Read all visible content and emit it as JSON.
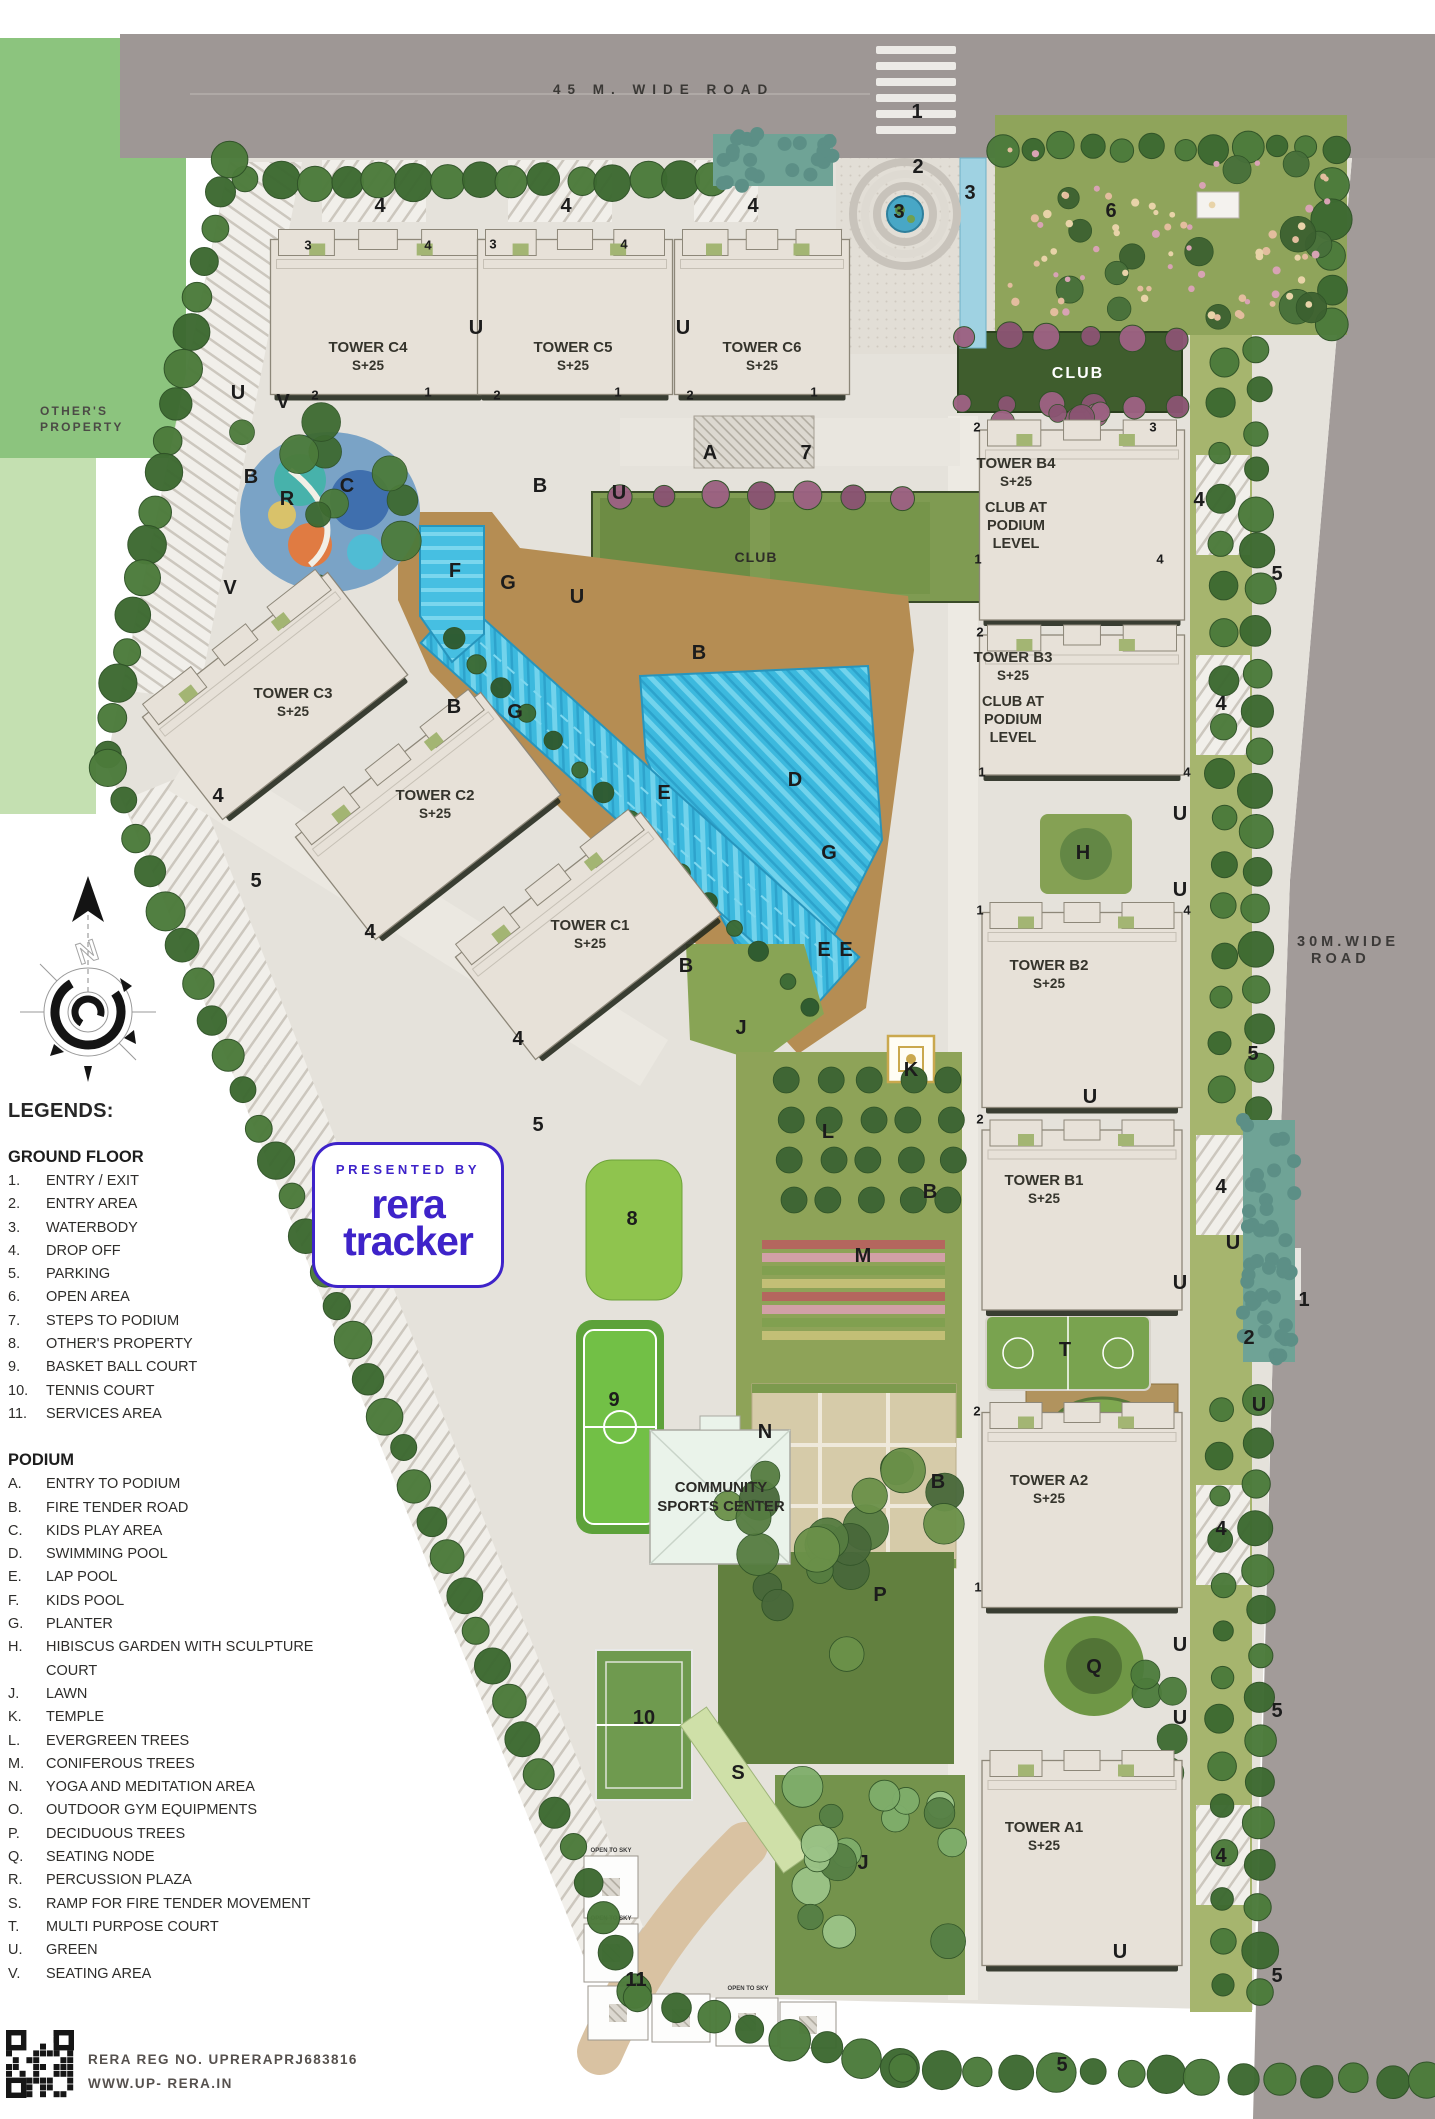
{
  "roads": {
    "top_label": "45 M. WIDE ROAD",
    "right_line1": "30M.WIDE",
    "right_line2": "ROAD"
  },
  "neighbor": {
    "line1": "OTHER'S",
    "line2": "PROPERTY"
  },
  "legend": {
    "title": "LEGENDS:",
    "sections": [
      {
        "title": "GROUND FLOOR",
        "items": [
          {
            "key": "1.",
            "label": "ENTRY / EXIT"
          },
          {
            "key": "2.",
            "label": "ENTRY AREA"
          },
          {
            "key": "3.",
            "label": "WATERBODY"
          },
          {
            "key": "4.",
            "label": "DROP OFF"
          },
          {
            "key": "5.",
            "label": "PARKING"
          },
          {
            "key": "6.",
            "label": "OPEN AREA"
          },
          {
            "key": "7.",
            "label": "STEPS TO PODIUM"
          },
          {
            "key": "8.",
            "label": "OTHER'S PROPERTY"
          },
          {
            "key": "9.",
            "label": "BASKET BALL COURT"
          },
          {
            "key": "10.",
            "label": "TENNIS COURT"
          },
          {
            "key": "11.",
            "label": "SERVICES AREA"
          }
        ]
      },
      {
        "title": "PODIUM",
        "items": [
          {
            "key": "A.",
            "label": "ENTRY TO PODIUM"
          },
          {
            "key": "B.",
            "label": "FIRE TENDER ROAD"
          },
          {
            "key": "C.",
            "label": "KIDS PLAY AREA"
          },
          {
            "key": "D.",
            "label": "SWIMMING POOL"
          },
          {
            "key": "E.",
            "label": "LAP POOL"
          },
          {
            "key": "F.",
            "label": "KIDS POOL"
          },
          {
            "key": "G.",
            "label": "PLANTER"
          },
          {
            "key": "H.",
            "label": "HIBISCUS GARDEN WITH SCULPTURE COURT"
          },
          {
            "key": "J.",
            "label": "LAWN"
          },
          {
            "key": "K.",
            "label": "TEMPLE"
          },
          {
            "key": "L.",
            "label": "EVERGREEN TREES"
          },
          {
            "key": "M.",
            "label": "CONIFEROUS TREES"
          },
          {
            "key": "N.",
            "label": "YOGA AND MEDITATION AREA"
          },
          {
            "key": "O.",
            "label": "OUTDOOR GYM EQUIPMENTS"
          },
          {
            "key": "P.",
            "label": "DECIDUOUS TREES"
          },
          {
            "key": "Q.",
            "label": "SEATING NODE"
          },
          {
            "key": "R.",
            "label": "PERCUSSION PLAZA"
          },
          {
            "key": "S.",
            "label": "RAMP FOR FIRE TENDER MOVEMENT"
          },
          {
            "key": "T.",
            "label": "MULTI PURPOSE COURT"
          },
          {
            "key": "U.",
            "label": "GREEN"
          },
          {
            "key": "V.",
            "label": "SEATING AREA"
          }
        ]
      }
    ]
  },
  "badge": {
    "presented_by": "PRESENTED BY",
    "brand_line1": "rera",
    "brand_line2": "tracker",
    "color": "#3e23c9"
  },
  "footer": {
    "reg": "RERA REG NO. UPRERAPRJ683816",
    "site": "WWW.UP- RERA.IN"
  },
  "map": {
    "towers": [
      {
        "id": "c4",
        "name": "TOWER C4",
        "floors": "S+25",
        "x": 378,
        "y": 312,
        "w": 215,
        "h": 165,
        "rot": 0,
        "lx": 368,
        "ly": 352
      },
      {
        "id": "c5",
        "name": "TOWER C5",
        "floors": "S+25",
        "x": 575,
        "y": 312,
        "w": 195,
        "h": 165,
        "rot": 0,
        "lx": 573,
        "ly": 352
      },
      {
        "id": "c6",
        "name": "TOWER C6",
        "floors": "S+25",
        "x": 762,
        "y": 312,
        "w": 175,
        "h": 165,
        "rot": 0,
        "lx": 762,
        "ly": 352
      },
      {
        "id": "b4",
        "name": "TOWER B4",
        "floors": "S+25",
        "x": 1082,
        "y": 520,
        "w": 205,
        "h": 200,
        "rot": 0,
        "lx": 1016,
        "ly": 468,
        "extra": [
          "CLUB AT",
          "PODIUM",
          "LEVEL"
        ]
      },
      {
        "id": "b3",
        "name": "TOWER B3",
        "floors": "S+25",
        "x": 1082,
        "y": 700,
        "w": 205,
        "h": 150,
        "rot": 0,
        "lx": 1013,
        "ly": 662,
        "extra": [
          "CLUB AT",
          "PODIUM",
          "LEVEL"
        ]
      },
      {
        "id": "c3",
        "name": "TOWER C3",
        "floors": "S+25",
        "x": 272,
        "y": 692,
        "w": 235,
        "h": 140,
        "rot": -38,
        "lx": 293,
        "ly": 698
      },
      {
        "id": "c2",
        "name": "TOWER C2",
        "floors": "S+25",
        "x": 425,
        "y": 812,
        "w": 235,
        "h": 140,
        "rot": -38,
        "lx": 435,
        "ly": 800
      },
      {
        "id": "c1",
        "name": "TOWER C1",
        "floors": "S+25",
        "x": 585,
        "y": 932,
        "w": 235,
        "h": 140,
        "rot": -38,
        "lx": 590,
        "ly": 930
      },
      {
        "id": "b2",
        "name": "TOWER B2",
        "floors": "S+25",
        "x": 1082,
        "y": 1005,
        "w": 200,
        "h": 205,
        "rot": 0,
        "lx": 1049,
        "ly": 970
      },
      {
        "id": "b1",
        "name": "TOWER B1",
        "floors": "S+25",
        "x": 1082,
        "y": 1215,
        "w": 200,
        "h": 190,
        "rot": 0,
        "lx": 1044,
        "ly": 1185
      },
      {
        "id": "a2",
        "name": "TOWER A2",
        "floors": "S+25",
        "x": 1082,
        "y": 1505,
        "w": 200,
        "h": 205,
        "rot": 0,
        "lx": 1049,
        "ly": 1485
      },
      {
        "id": "a1",
        "name": "TOWER A1",
        "floors": "S+25",
        "x": 1082,
        "y": 1858,
        "w": 200,
        "h": 215,
        "rot": 0,
        "lx": 1044,
        "ly": 1832
      }
    ],
    "clubs": [
      {
        "label": "CLUB",
        "x": 1078,
        "y": 378,
        "color": "#ffffff",
        "size": 16,
        "ls": 2
      },
      {
        "label": "CLUB",
        "x": 756,
        "y": 562,
        "color": "#2e2d28",
        "size": 14,
        "ls": 1
      }
    ],
    "community": {
      "line1": "COMMUNITY",
      "line2": "SPORTS CENTER",
      "x": 721,
      "y": 1492
    },
    "open_to_sky": "OPEN TO SKY",
    "markers": [
      [
        "1",
        917,
        111,
        "lg"
      ],
      [
        "2",
        918,
        166,
        "lg"
      ],
      [
        "3",
        970,
        192,
        "lg"
      ],
      [
        "3",
        899,
        211,
        "lg"
      ],
      [
        "6",
        1111,
        210,
        "lg"
      ],
      [
        "4",
        380,
        205,
        "lg"
      ],
      [
        "4",
        566,
        205,
        "lg"
      ],
      [
        "4",
        753,
        205,
        "lg"
      ],
      [
        "7",
        806,
        452,
        "lg"
      ],
      [
        "A",
        710,
        452,
        "lg"
      ],
      [
        "5",
        256,
        880,
        "lg"
      ],
      [
        "5",
        538,
        1124,
        "lg"
      ],
      [
        "5",
        1277,
        573,
        "lg"
      ],
      [
        "5",
        1253,
        1053,
        "lg"
      ],
      [
        "5",
        1277,
        1710,
        "lg"
      ],
      [
        "5",
        1277,
        1975,
        "lg"
      ],
      [
        "5",
        1062,
        2064,
        "lg"
      ],
      [
        "4",
        218,
        795,
        "lg"
      ],
      [
        "4",
        370,
        931,
        "lg"
      ],
      [
        "4",
        518,
        1038,
        "lg"
      ],
      [
        "4",
        1199,
        499,
        "lg"
      ],
      [
        "4",
        1221,
        703,
        "lg"
      ],
      [
        "4",
        1221,
        1186,
        "lg"
      ],
      [
        "4",
        1221,
        1528,
        "lg"
      ],
      [
        "4",
        1221,
        1855,
        "lg"
      ],
      [
        "8",
        632,
        1218,
        "lg"
      ],
      [
        "9",
        614,
        1399,
        "lg"
      ],
      [
        "10",
        644,
        1717,
        "lg"
      ],
      [
        "11",
        636,
        1979,
        "lg"
      ],
      [
        "B",
        540,
        485,
        "lg"
      ],
      [
        "B",
        251,
        476,
        "lg"
      ],
      [
        "B",
        454,
        706,
        "lg"
      ],
      [
        "B",
        699,
        652,
        "lg"
      ],
      [
        "B",
        686,
        965,
        "lg"
      ],
      [
        "B",
        930,
        1191,
        "lg"
      ],
      [
        "B",
        938,
        1481,
        "lg"
      ],
      [
        "C",
        347,
        485,
        "lg"
      ],
      [
        "D",
        795,
        779,
        "lg"
      ],
      [
        "E",
        664,
        792,
        "lg"
      ],
      [
        "E",
        824,
        949,
        "lg"
      ],
      [
        "E",
        846,
        949,
        "lg"
      ],
      [
        "F",
        455,
        570,
        "lg"
      ],
      [
        "G",
        508,
        582,
        "lg"
      ],
      [
        "G",
        515,
        711,
        "lg"
      ],
      [
        "G",
        829,
        852,
        "lg"
      ],
      [
        "H",
        1083,
        852,
        "lg"
      ],
      [
        "J",
        741,
        1027,
        "lg"
      ],
      [
        "J",
        863,
        1862,
        "lg"
      ],
      [
        "K",
        911,
        1069,
        "lg"
      ],
      [
        "L",
        828,
        1131,
        "lg"
      ],
      [
        "M",
        863,
        1255,
        "lg"
      ],
      [
        "N",
        765,
        1431,
        "lg"
      ],
      [
        "P",
        880,
        1594,
        "lg"
      ],
      [
        "Q",
        1094,
        1666,
        "lg"
      ],
      [
        "R",
        287,
        498,
        "lg"
      ],
      [
        "S",
        738,
        1772,
        "lg"
      ],
      [
        "T",
        1065,
        1349,
        "lg"
      ],
      [
        "U",
        238,
        392,
        "lg"
      ],
      [
        "U",
        476,
        327,
        "lg"
      ],
      [
        "U",
        683,
        327,
        "lg"
      ],
      [
        "U",
        577,
        596,
        "lg"
      ],
      [
        "U",
        619,
        492,
        "lg"
      ],
      [
        "U",
        1180,
        813,
        "lg"
      ],
      [
        "U",
        1180,
        889,
        "lg"
      ],
      [
        "U",
        1090,
        1096,
        "lg"
      ],
      [
        "U",
        1180,
        1282,
        "lg"
      ],
      [
        "U",
        1259,
        1404,
        "lg"
      ],
      [
        "U",
        1180,
        1644,
        "lg"
      ],
      [
        "U",
        1180,
        1717,
        "lg"
      ],
      [
        "U",
        1120,
        1951,
        "lg"
      ],
      [
        "U",
        1233,
        1242,
        "lg"
      ],
      [
        "V",
        283,
        401,
        "lg"
      ],
      [
        "V",
        230,
        587,
        "lg"
      ],
      [
        "1",
        1304,
        1299,
        "lg"
      ],
      [
        "2",
        1249,
        1337,
        "lg"
      ],
      [
        "3",
        308,
        245,
        "sm"
      ],
      [
        "4",
        428,
        245,
        "sm"
      ],
      [
        "3",
        493,
        244,
        "sm"
      ],
      [
        "4",
        624,
        244,
        "sm"
      ],
      [
        "2",
        315,
        395,
        "sm"
      ],
      [
        "1",
        428,
        392,
        "sm"
      ],
      [
        "2",
        497,
        395,
        "sm"
      ],
      [
        "1",
        618,
        392,
        "sm"
      ],
      [
        "2",
        690,
        395,
        "sm"
      ],
      [
        "1",
        814,
        392,
        "sm"
      ],
      [
        "2",
        977,
        427,
        "sm"
      ],
      [
        "3",
        1153,
        427,
        "sm"
      ],
      [
        "1",
        978,
        559,
        "sm"
      ],
      [
        "4",
        1160,
        559,
        "sm"
      ],
      [
        "2",
        980,
        632,
        "sm"
      ],
      [
        "1",
        982,
        772,
        "sm"
      ],
      [
        "4",
        1187,
        772,
        "sm"
      ],
      [
        "1",
        980,
        910,
        "sm"
      ],
      [
        "4",
        1187,
        910,
        "sm"
      ],
      [
        "2",
        980,
        1119,
        "sm"
      ],
      [
        "2",
        977,
        1411,
        "sm"
      ],
      [
        "1",
        978,
        1587,
        "sm"
      ]
    ]
  },
  "colors": {
    "accent": "#3e23c9",
    "road": "#9e9795",
    "paving": "#e5e2db",
    "tower": "#e7e1d8",
    "pool": "#3cb9de",
    "tree_dark": "#3d6a31",
    "tree_mid": "#4c7b3b",
    "lawn": "#8fa45b",
    "club_green": "#3f5d2d",
    "purple_tree": "#9c6282",
    "deck": "#b58d53"
  }
}
